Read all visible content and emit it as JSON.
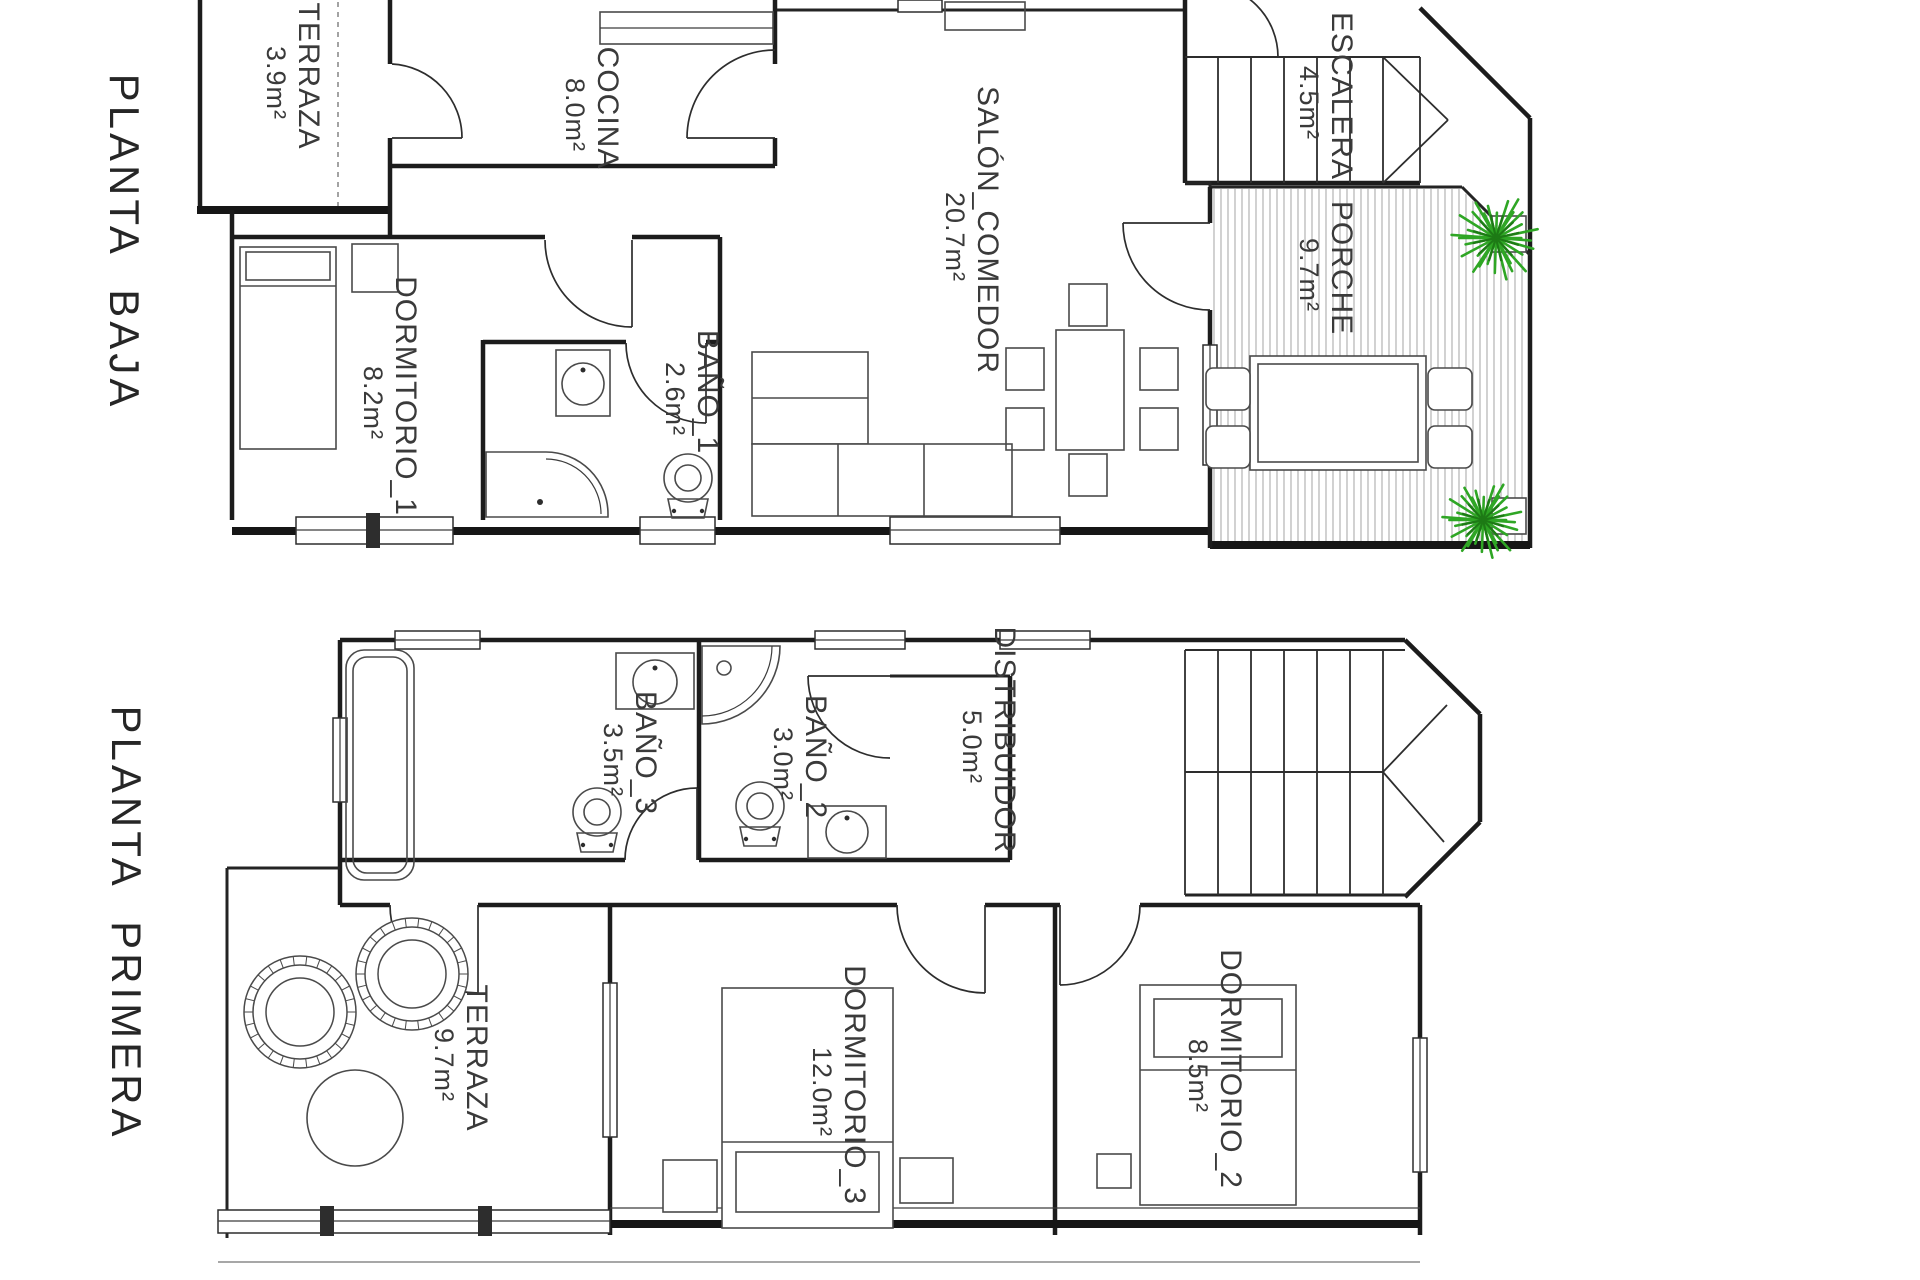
{
  "floors": [
    {
      "title": "PLANTA BAJA",
      "rooms": [
        {
          "name": "TERRAZA",
          "area": "3.9m²"
        },
        {
          "name": "COCINA",
          "area": "8.0m²"
        },
        {
          "name": "SALÓN_COMEDOR",
          "area": "20.7m²"
        },
        {
          "name": "ESCALERA",
          "area": "4.5m²"
        },
        {
          "name": "PORCHE",
          "area": "9.7m²"
        },
        {
          "name": "DORMITORIO_1",
          "area": "8.2m²"
        },
        {
          "name": "BAÑO_1",
          "area": "2.6m²"
        }
      ]
    },
    {
      "title": "PLANTA PRIMERA",
      "rooms": [
        {
          "name": "BAÑO_3",
          "area": "3.5m²"
        },
        {
          "name": "BAÑO_2",
          "area": "3.0m²"
        },
        {
          "name": "DISTRIBUIDOR",
          "area": "5.0m²"
        },
        {
          "name": "TERRAZA",
          "area": "9.7m²"
        },
        {
          "name": "DORMITORIO_3",
          "area": "12.0m²"
        },
        {
          "name": "DORMITORIO_2",
          "area": "8.5m²"
        }
      ]
    }
  ],
  "colors": {
    "background": "#ffffff",
    "wall": "#1c1c1c",
    "furniture": "#4a4a4a",
    "hatch": "#9a9a9a",
    "text": "#3a3a3a",
    "plant": "#2fa625"
  }
}
